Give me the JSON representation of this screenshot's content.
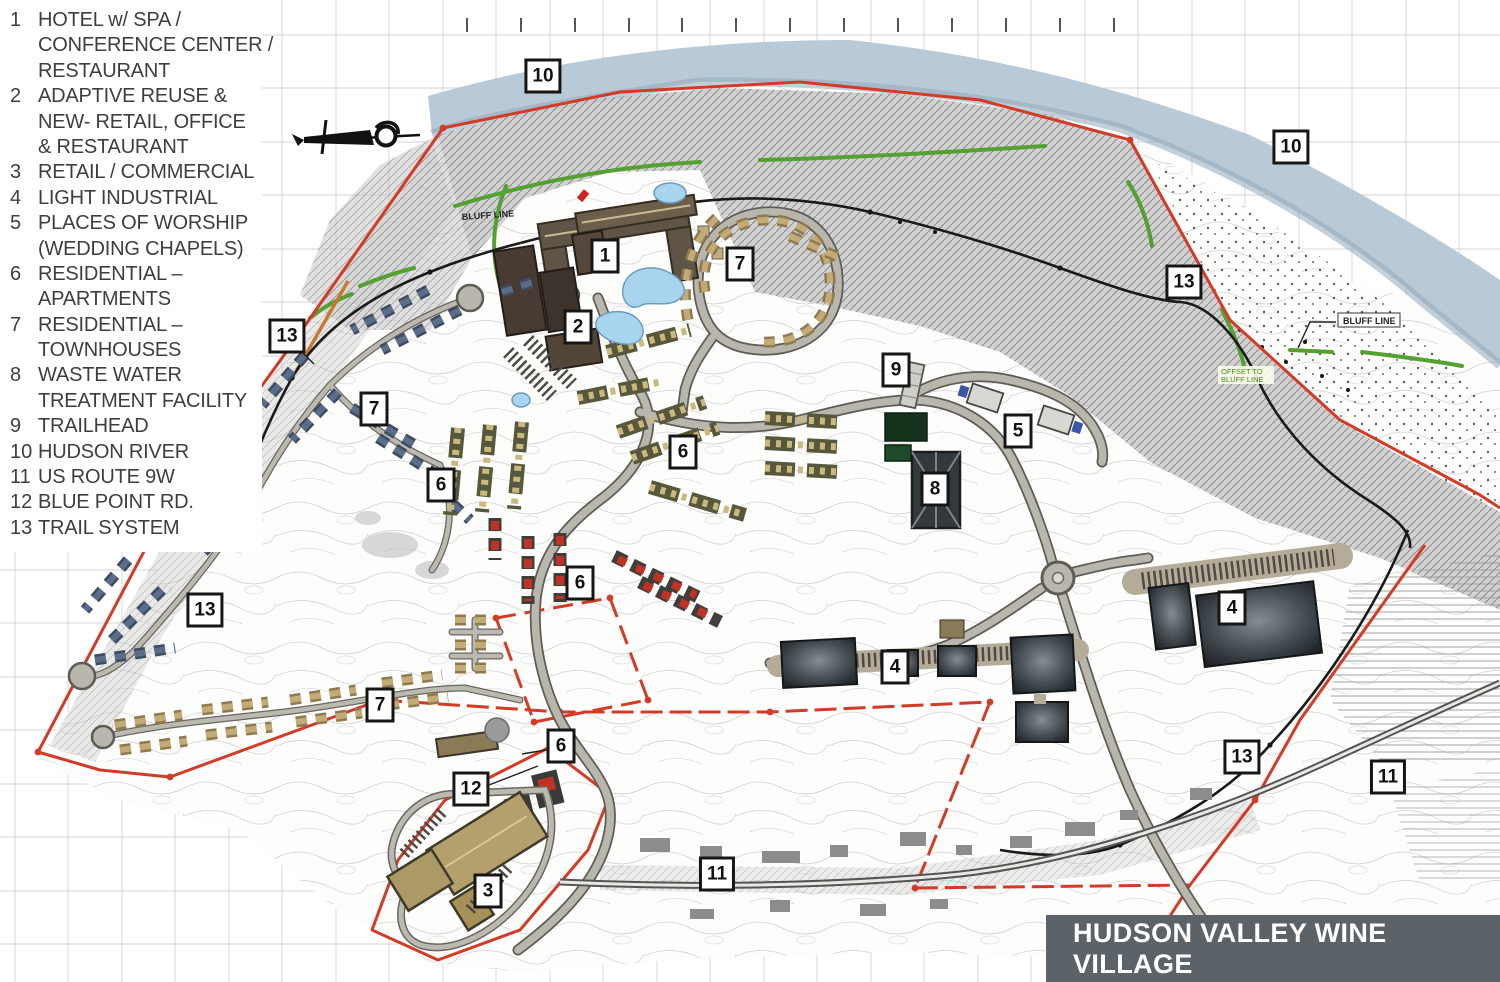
{
  "legend": {
    "items": [
      {
        "num": "1",
        "lines": [
          "HOTEL w/ SPA /",
          "CONFERENCE CENTER /",
          "RESTAURANT"
        ]
      },
      {
        "num": "2",
        "lines": [
          "ADAPTIVE REUSE &",
          "NEW- RETAIL, OFFICE",
          "& RESTAURANT"
        ]
      },
      {
        "num": "3",
        "lines": [
          "RETAIL / COMMERCIAL"
        ]
      },
      {
        "num": "4",
        "lines": [
          "LIGHT INDUSTRIAL"
        ]
      },
      {
        "num": "5",
        "lines": [
          "PLACES OF WORSHIP",
          "(WEDDING CHAPELS)"
        ]
      },
      {
        "num": "6",
        "lines": [
          "RESIDENTIAL –",
          "APARTMENTS"
        ]
      },
      {
        "num": "7",
        "lines": [
          "RESIDENTIAL –",
          "TOWNHOUSES"
        ]
      },
      {
        "num": "8",
        "lines": [
          "WASTE WATER",
          "TREATMENT FACILITY"
        ]
      },
      {
        "num": "9",
        "lines": [
          "TRAILHEAD"
        ]
      },
      {
        "num": "10",
        "lines": [
          "HUDSON RIVER"
        ]
      },
      {
        "num": "11",
        "lines": [
          "US ROUTE 9W"
        ]
      },
      {
        "num": "12",
        "lines": [
          "BLUE POINT RD."
        ]
      },
      {
        "num": "13",
        "lines": [
          "TRAIL SYSTEM"
        ]
      }
    ]
  },
  "title_block": {
    "text": "HUDSON VALLEY WINE VILLAGE"
  },
  "map": {
    "markers": [
      {
        "label": "10",
        "x": 543,
        "y": 76
      },
      {
        "label": "10",
        "x": 1291,
        "y": 147
      },
      {
        "label": "13",
        "x": 287,
        "y": 336
      },
      {
        "label": "13",
        "x": 1184,
        "y": 282
      },
      {
        "label": "13",
        "x": 205,
        "y": 610
      },
      {
        "label": "13",
        "x": 1242,
        "y": 757
      },
      {
        "label": "1",
        "x": 605,
        "y": 256
      },
      {
        "label": "2",
        "x": 578,
        "y": 327
      },
      {
        "label": "7",
        "x": 740,
        "y": 264
      },
      {
        "label": "7",
        "x": 374,
        "y": 409
      },
      {
        "label": "7",
        "x": 380,
        "y": 705
      },
      {
        "label": "6",
        "x": 441,
        "y": 485
      },
      {
        "label": "6",
        "x": 683,
        "y": 452
      },
      {
        "label": "6",
        "x": 580,
        "y": 583
      },
      {
        "label": "6",
        "x": 561,
        "y": 746
      },
      {
        "label": "9",
        "x": 896,
        "y": 370
      },
      {
        "label": "5",
        "x": 1018,
        "y": 431
      },
      {
        "label": "8",
        "x": 935,
        "y": 489
      },
      {
        "label": "4",
        "x": 1232,
        "y": 608
      },
      {
        "label": "4",
        "x": 895,
        "y": 667
      },
      {
        "label": "12",
        "x": 471,
        "y": 789
      },
      {
        "label": "3",
        "x": 488,
        "y": 891
      },
      {
        "label": "11",
        "x": 717,
        "y": 874
      },
      {
        "label": "11",
        "x": 1388,
        "y": 777
      }
    ],
    "labels": {
      "bluff_line": "BLUFF LINE",
      "offset_line1": "OFFSET TO",
      "offset_line2": "BLUFF LINE"
    },
    "colors": {
      "river": "#b8cad8",
      "boundary_red": "#d23b27",
      "trail_black": "#1a1a1a",
      "trail_green": "#55a032",
      "road_fill": "#b9b6ad",
      "title_bar_bg": "#5b6268",
      "legend_text": "#3e3e3e",
      "marker_border": "#161616",
      "bluff_gray": "#9b9b9b",
      "apartment_olive": "#57573c",
      "townhouse_blue": "#3e4b61",
      "townhouse_tan": "#8f7a4f",
      "apartment_red": "#c23126",
      "industrial_dark": "#23282c"
    }
  }
}
